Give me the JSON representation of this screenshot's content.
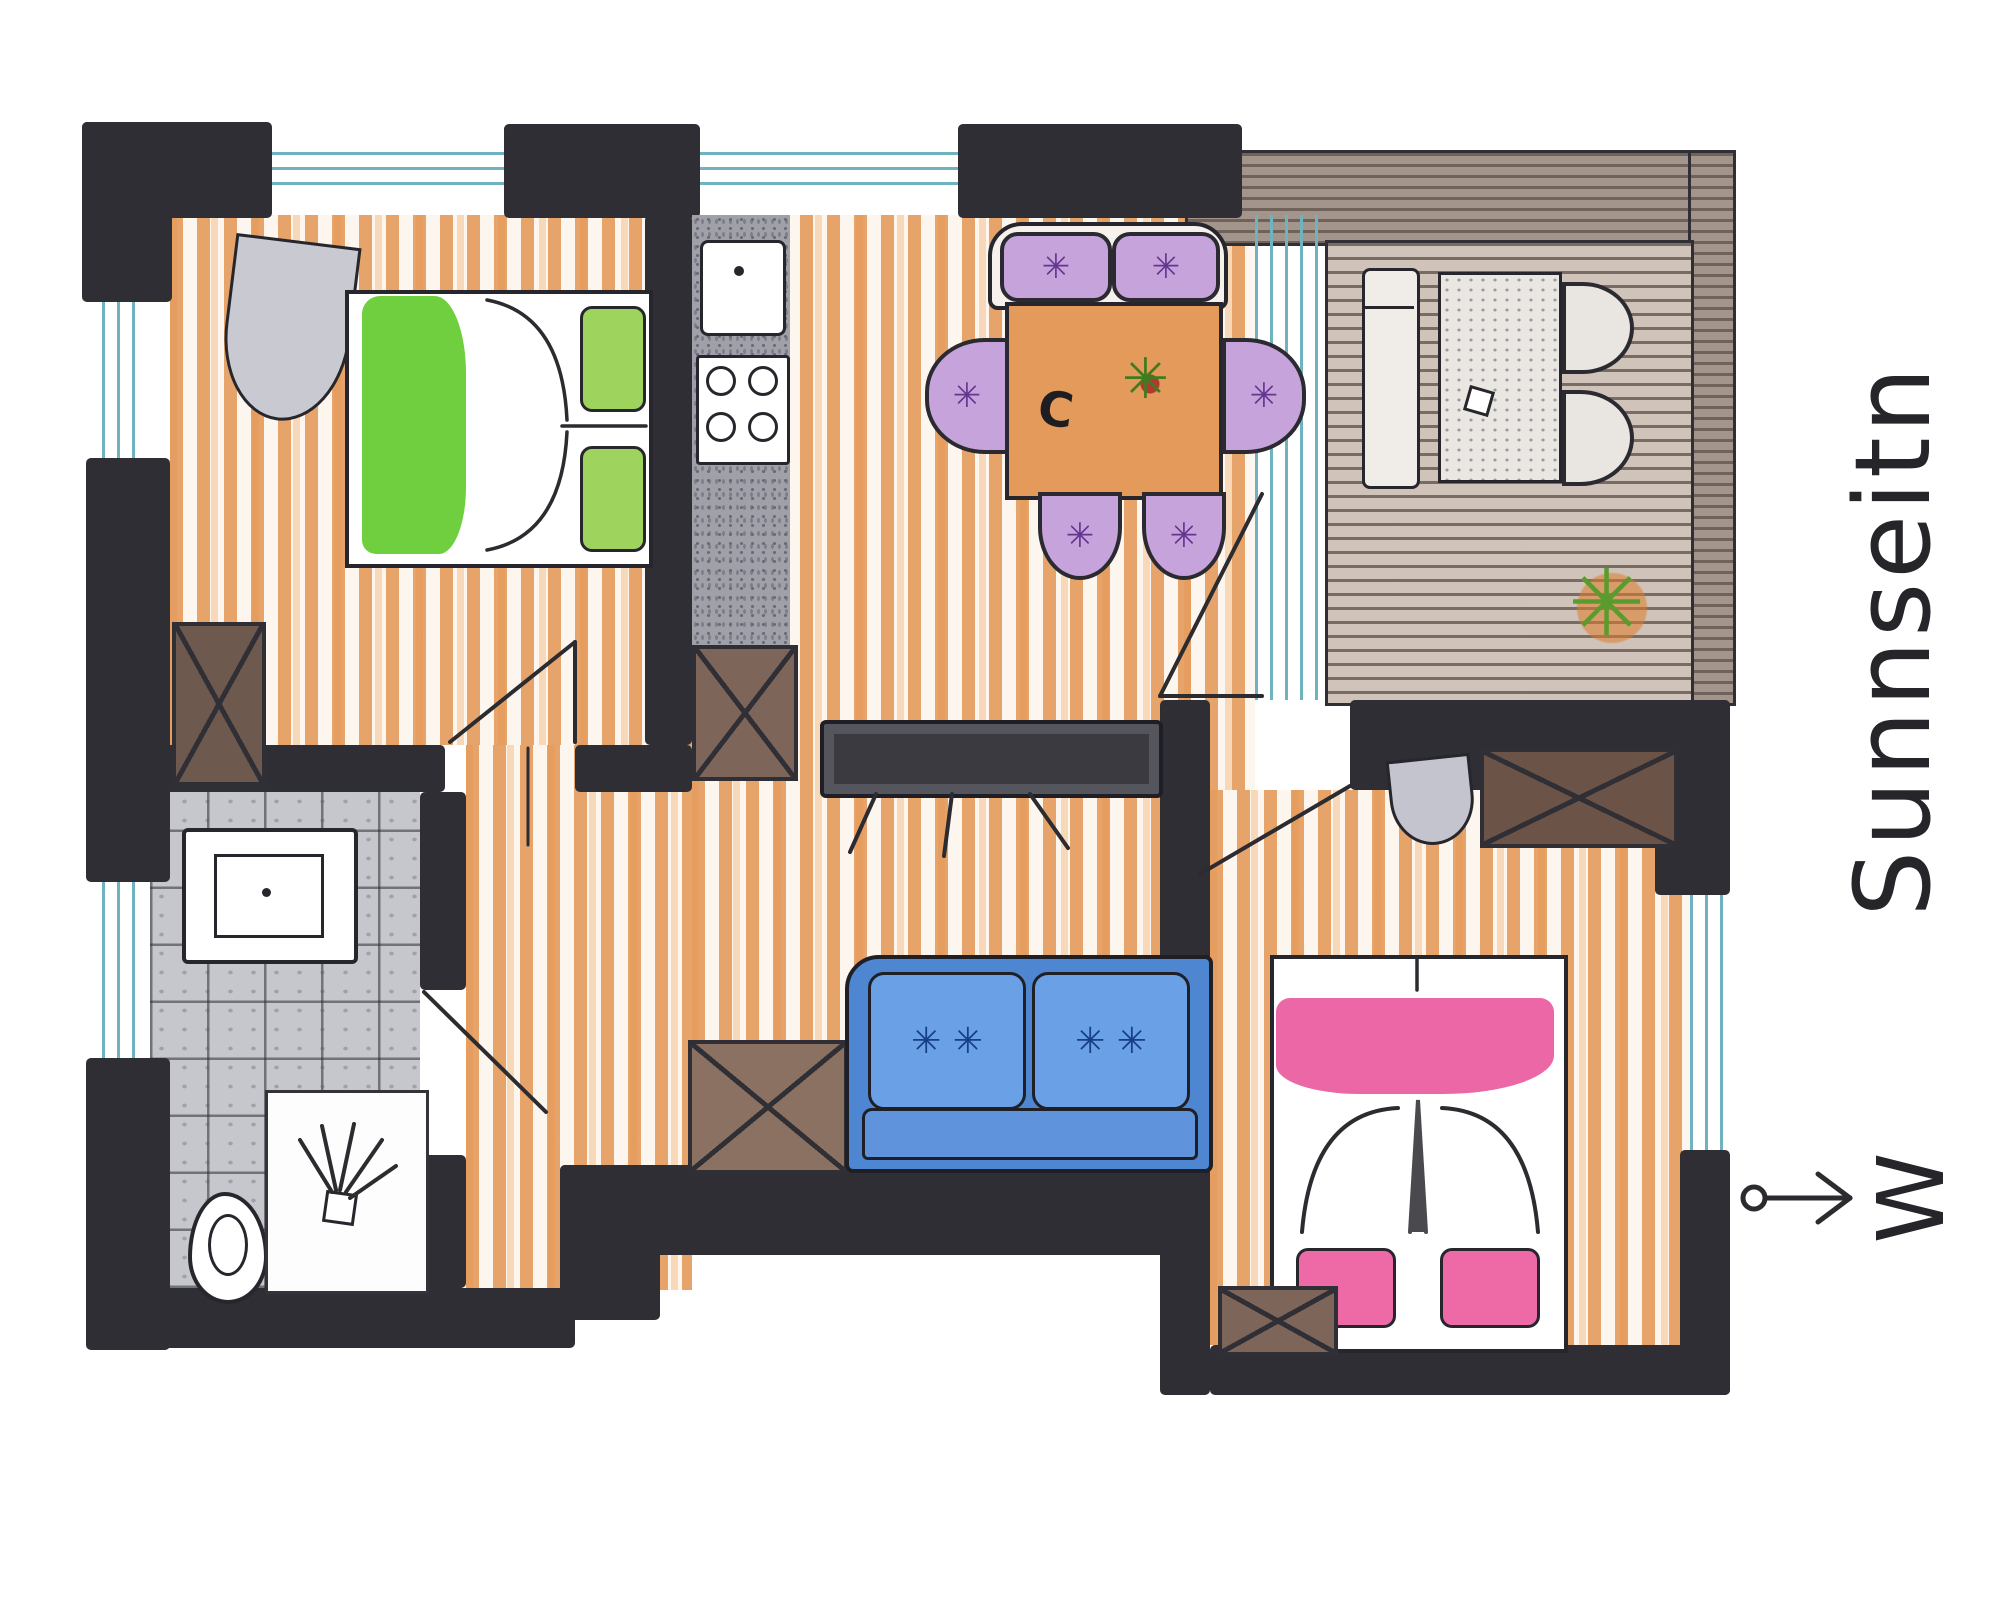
{
  "title": "Sunnseitn",
  "compass": {
    "letter": "W"
  },
  "icons": {
    "chair_star": "✳",
    "sofa_star": "✳ ✳",
    "plant_living": "✳",
    "plant_balcony": "✳",
    "table_mark": "C"
  },
  "palette": {
    "wall": "#2e2e34",
    "wood_stroke": "#e08d46",
    "green_duvet": "#6fcf3f",
    "green_pillow": "#9ed45e",
    "purple_chair": "#c7a3dc",
    "blue_sofa": "#4f86d2",
    "blue_cushion": "#6aa0e6",
    "pink_band": "#ea5a9d",
    "pink_pillow": "#ee6aa6",
    "table_wood": "#e49a5b",
    "glass": "#6fb3c0",
    "tile": "#c6c6cd",
    "deck": "#cfc3ba",
    "cabinet_brown": "#7d655a"
  }
}
